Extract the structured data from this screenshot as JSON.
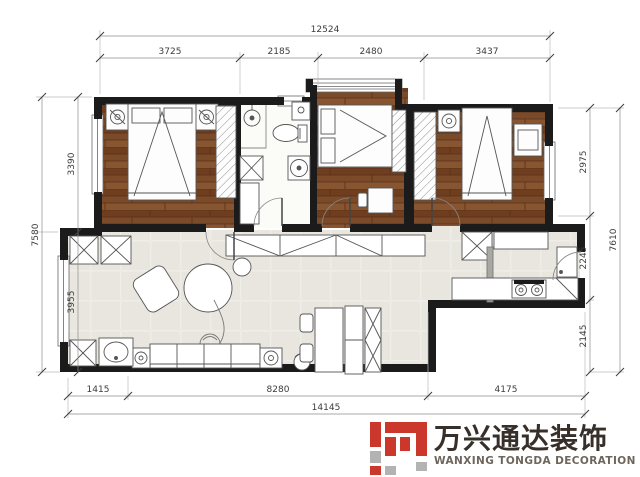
{
  "floorplan": {
    "dimensions": {
      "top_total": "12524",
      "top_segments": [
        "3725",
        "2185",
        "2480",
        "3437"
      ],
      "left_total": "7580",
      "left_segments": [
        "3390",
        "3955"
      ],
      "right_total": "7610",
      "right_segments": [
        "2975",
        "2245",
        "2145"
      ],
      "bottom_total": "14145",
      "bottom_segments": [
        "1415",
        "8280",
        "4175"
      ]
    },
    "colors": {
      "wall": "#1b1b1b",
      "wood_floor": "#7b4a28",
      "tile_floor": "#e8e6df",
      "line": "#555555"
    }
  },
  "logo": {
    "chinese": "万兴通达装饰",
    "english": "WANXING TONGDA DECORATION",
    "colors": {
      "red": "#cc372b",
      "gray": "#b3b3b3",
      "cn_text": "#37302a",
      "en_text": "#6e665c"
    }
  }
}
